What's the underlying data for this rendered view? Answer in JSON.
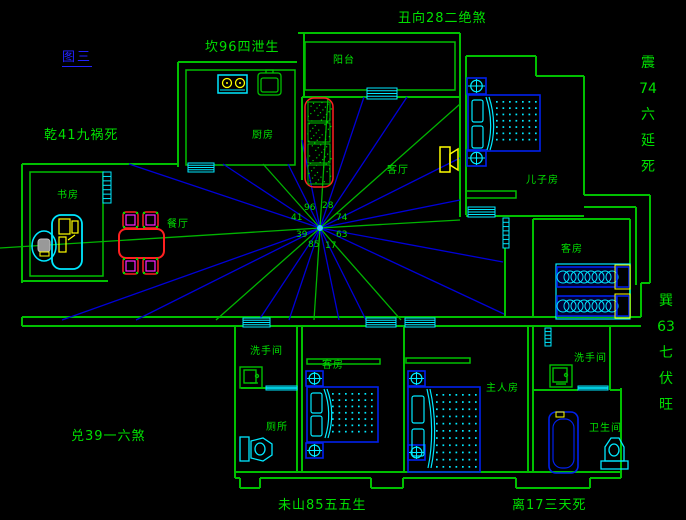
{
  "figure_label": "图三",
  "annotations": {
    "top": "丑向28二绝煞",
    "top_left": "坎96四泄生",
    "left": "乾41九祸死",
    "bottom_left": "兑39一六煞",
    "bottom_center": "未山85五五生",
    "bottom_right": "离17三天死",
    "right_upper_chars": [
      "震",
      "74",
      "六",
      "延",
      "死"
    ],
    "right_lower_chars": [
      "巽",
      "63",
      "七",
      "伏",
      "旺"
    ]
  },
  "compass_numbers": {
    "nnw": "96",
    "nne": "28",
    "wnw": "41",
    "ene": "74",
    "wsw": "39",
    "ese": "63",
    "ssw": "85",
    "sse": "17"
  },
  "rooms": {
    "balcony": "阳台",
    "kitchen": "厨房",
    "living_room": "客厅",
    "sons_room": "儿子房",
    "study": "书房",
    "dining_room": "餐厅",
    "guest_room_ne": "客房",
    "washroom_w": "洗手间",
    "toilet": "厕所",
    "guest_room_s": "客房",
    "master_room": "主人房",
    "washroom_e": "洗手间",
    "bathroom": "卫生间"
  },
  "colors": {
    "background": "#000000",
    "wall_green": "#00c000",
    "text_green": "#00e000",
    "ray_blue": "#0000d8",
    "furniture_blue": "#0020ee",
    "cyan": "#00e8ff",
    "red": "#ff2020",
    "magenta": "#ff22ff",
    "yellow": "#ffff00",
    "title_blue": "#2222ff"
  }
}
